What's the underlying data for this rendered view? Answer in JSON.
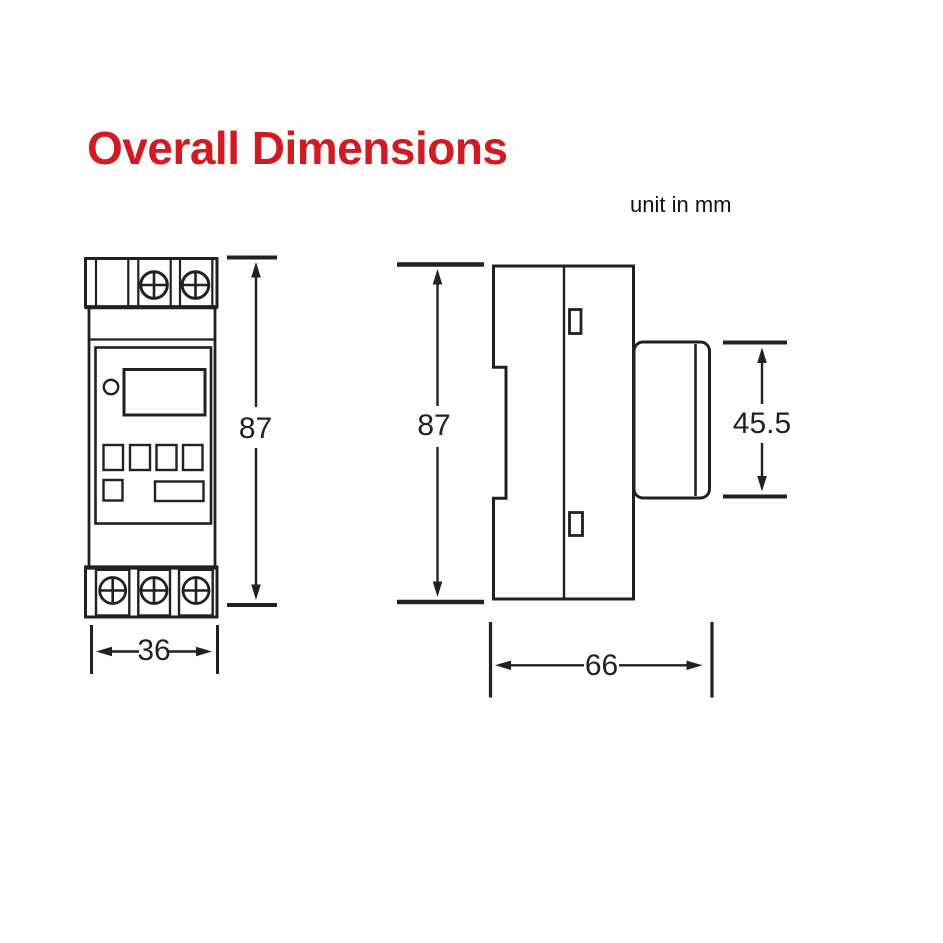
{
  "title": "Overall Dimensions",
  "unit_note": "unit in mm",
  "colors": {
    "accent": "#cf1c23",
    "line": "#241f21",
    "bg": "#ffffff"
  },
  "front_view": {
    "height_mm": "87",
    "width_mm": "36"
  },
  "side_view": {
    "height_mm": "87",
    "depth_mm": "66",
    "face_height_mm": "45.5"
  }
}
